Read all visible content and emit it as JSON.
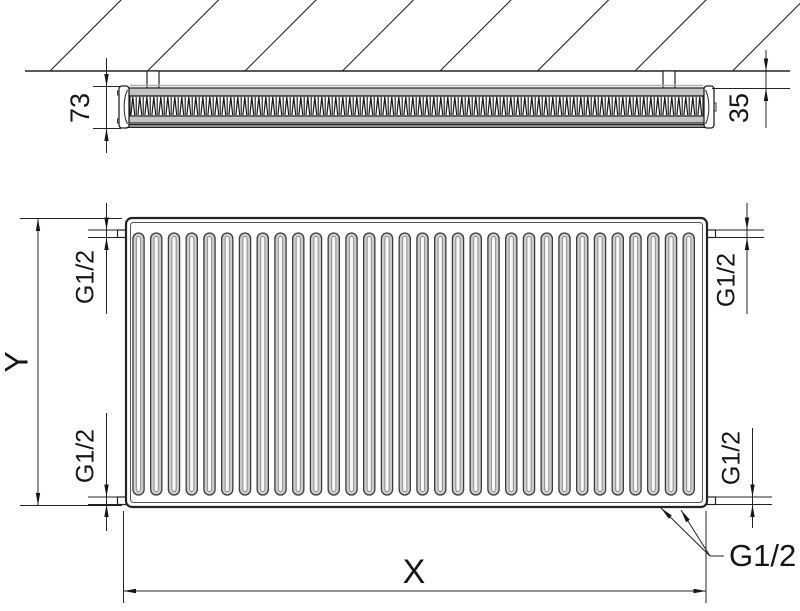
{
  "drawing": {
    "type": "panel radiator dimensional drawing",
    "views": "top cross-section with wall, front elevation",
    "line_color": "#232323",
    "panel_fill": "#c4c4c4",
    "front_face_fill": "#909090",
    "channel_fill": "#cdcdcd",
    "channel_inner_fill": "#f8f8f8",
    "background": "#ffffff"
  },
  "top_view": {
    "depth_dim": "73",
    "wall_gap_dim": "35"
  },
  "front_view": {
    "height_dim": "Y",
    "width_dim": "X",
    "connections": {
      "top_left": "G1/2",
      "top_right": "G1/2",
      "bottom_left": "G1/2",
      "bottom_right": "G1/2",
      "bottom_center": "G1/2"
    }
  },
  "geometry": {
    "channel_count": 32,
    "channel_first_center_x": 138.5,
    "channel_pitch": 17.75,
    "hatch_count": 8,
    "hatch_start_x": 50,
    "hatch_pitch": 97.5
  }
}
